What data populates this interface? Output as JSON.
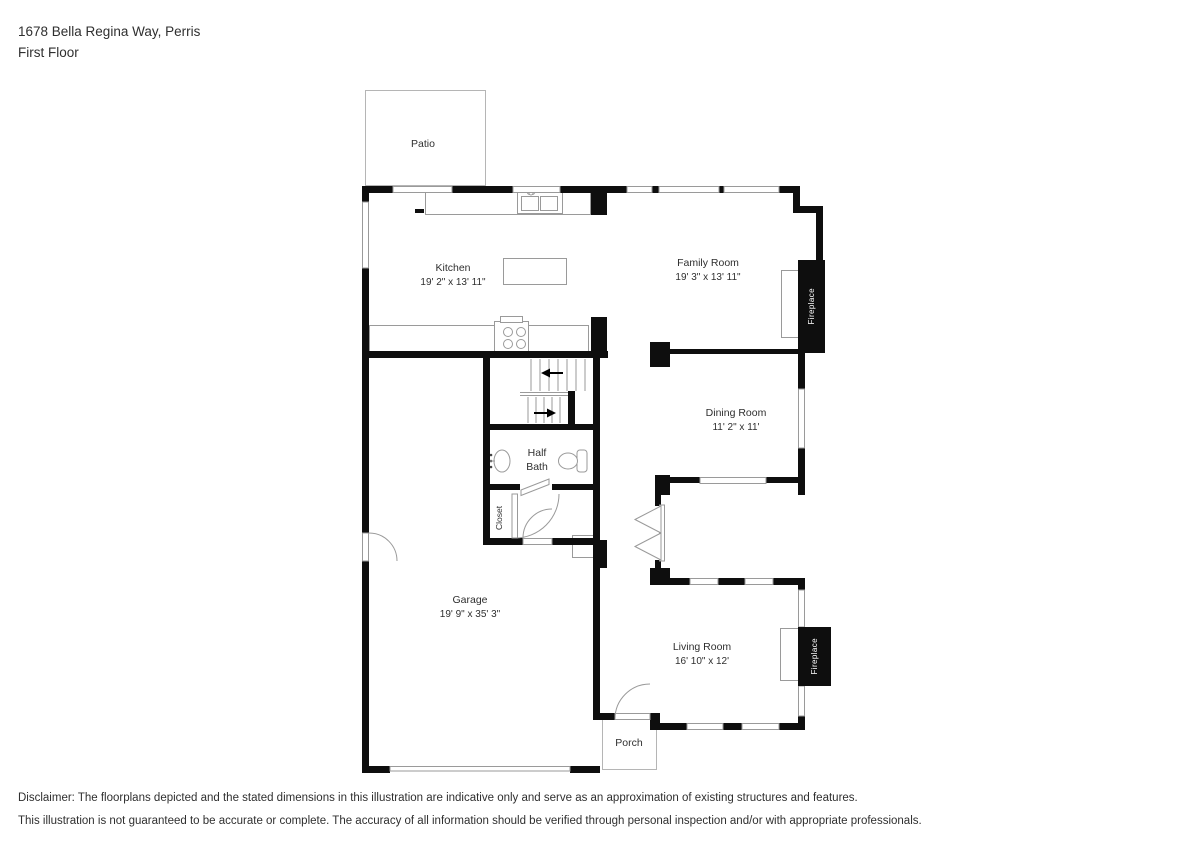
{
  "header": {
    "address": "1678 Bella Regina Way, Perris",
    "floor": "First Floor"
  },
  "rooms": {
    "patio": {
      "name": "Patio"
    },
    "kitchen": {
      "name": "Kitchen",
      "dims": "19' 2\" x 13' 11\""
    },
    "family": {
      "name": "Family Room",
      "dims": "19' 3\" x 13' 11\""
    },
    "dining": {
      "name": "Dining Room",
      "dims": "11' 2\" x 11'"
    },
    "halfbath": {
      "line1": "Half",
      "line2": "Bath"
    },
    "closet": {
      "name": "Closet"
    },
    "garage": {
      "name": "Garage",
      "dims": "19' 9\" x 35' 3\""
    },
    "living": {
      "name": "Living Room",
      "dims": "16' 10\" x 12'"
    },
    "porch": {
      "name": "Porch"
    },
    "fireplace_family": {
      "label": "Fireplace"
    },
    "fireplace_living": {
      "label": "Fireplace"
    }
  },
  "disclaimer": {
    "line1": "Disclaimer: The floorplans depicted and the stated dimensions in this illustration are indicative only and serve as an approximation of existing structures and features.",
    "line2": "This illustration is not guaranteed to be accurate or complete. The accuracy of all information should be verified through personal inspection and/or with appropriate professionals."
  },
  "colors": {
    "wall": "#0e0e0e",
    "outline": "#9a9a9a",
    "light": "#b5b5b5",
    "text": "#2f2f2f"
  }
}
